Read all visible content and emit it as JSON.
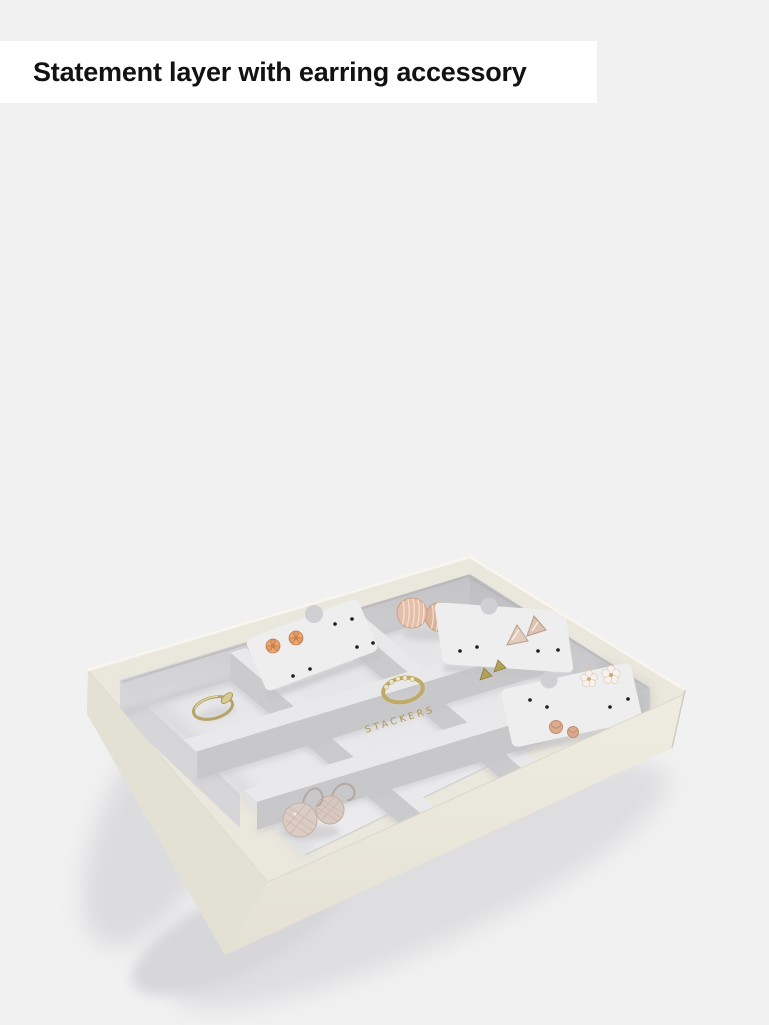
{
  "page": {
    "background_color": "#f1f1f2"
  },
  "caption": {
    "text": "Statement layer with earring accessory",
    "background_color": "#ffffff",
    "text_color": "#121212"
  },
  "product": {
    "alt": "oatmeal-9-section-jewellery-tray-with-grey-velvet-lining-earring-cards-and-jewellery",
    "brand_embossing": "STACKERS",
    "brand_color": "#b3974e",
    "colors": {
      "leather_exterior": "#eae7dd",
      "leather_front": "#e8e5d9",
      "velvet_floor": "#e6e6e8",
      "velvet_wall_shadow": "#c7c7ca",
      "earring_card": "#eeeeef",
      "gold": "#b5a468",
      "rose_gold": "#ddb49c",
      "champagne_silver": "#dccdc4",
      "drop_shadow": "#dadadc"
    },
    "jewelry_items": [
      "rose-gold-flower-studs",
      "shell-disc-earrings",
      "triangle-studs",
      "gold-wedge-studs",
      "blossom-studs",
      "gold-ring",
      "pave-gold-ring",
      "textured-disc-drop-earrings",
      "rose-gold-knot-earrings"
    ]
  }
}
